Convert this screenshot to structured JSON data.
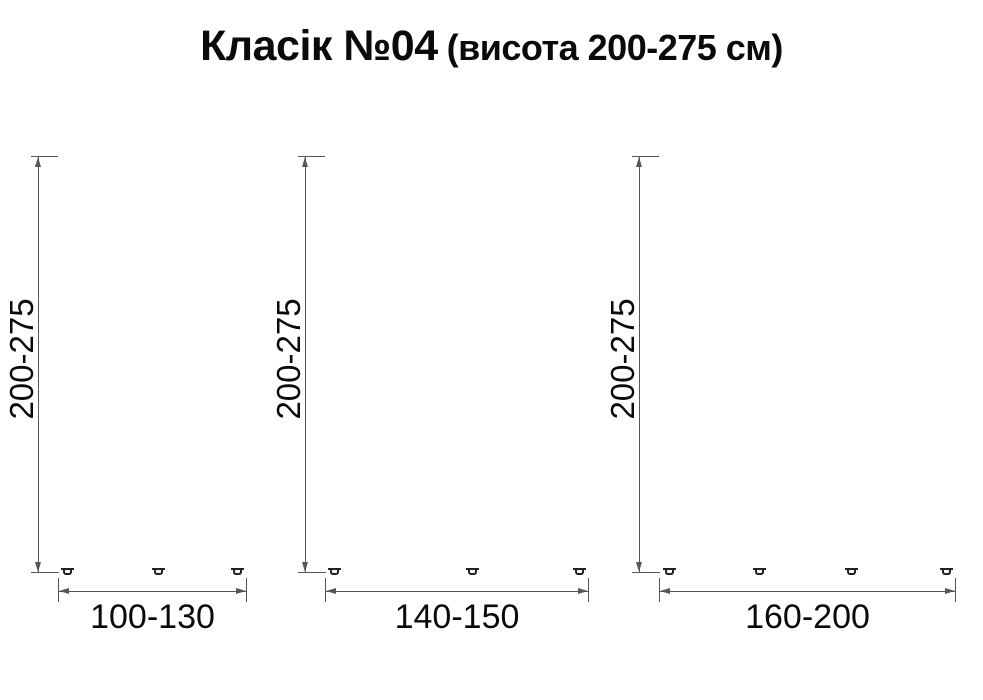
{
  "title": {
    "main": "Класік №04",
    "suffix": "(висота 200-275 см)"
  },
  "figures": [
    {
      "height_label": "200-275",
      "width_label": "100-130"
    },
    {
      "height_label": "200-275",
      "width_label": "140-150"
    },
    {
      "height_label": "200-275",
      "width_label": "160-200"
    }
  ]
}
